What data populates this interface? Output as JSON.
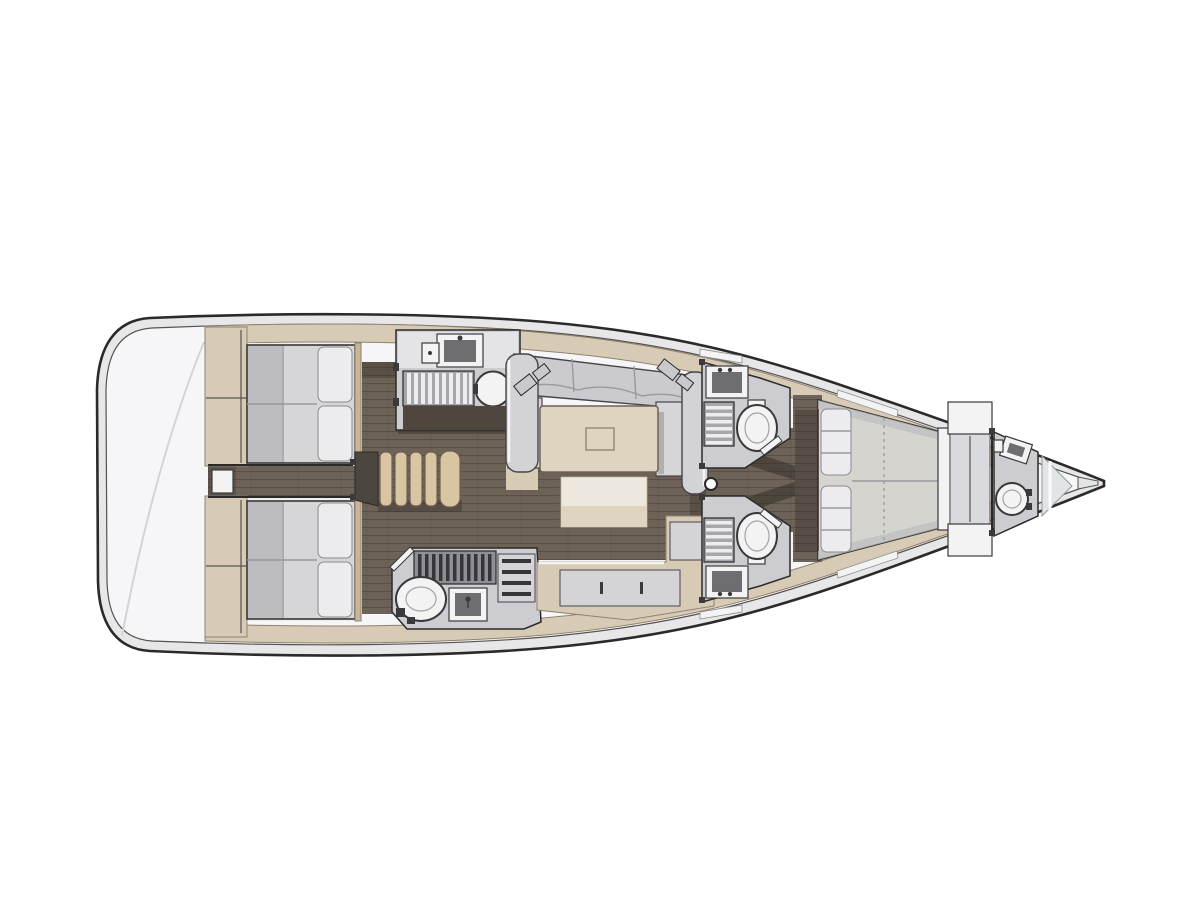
{
  "meta": {
    "title": "Sailing yacht interior layout plan, bow pointing right",
    "type": "floorplan-diagram",
    "orientation": "bow-right",
    "canvas": {
      "width": 1200,
      "height": 900
    }
  },
  "colors": {
    "bg": "#ffffff",
    "line-dark": "#2b2a28",
    "line-mid": "#55534f",
    "faint": "#d4d4d7",
    "hull-band": "#e7e7ea",
    "deck": "#f6f6f8",
    "beige": "#d8cbb6",
    "beige-border": "#8f8270",
    "beige-dark": "#c7b593",
    "floor": "#6d6257",
    "floor-line": "#594f45",
    "shadow": "#2e2922",
    "mattress": "#d6d6d9",
    "mattress-shade": "#bdbdc1",
    "pillow": "#ececee",
    "pillow-line": "#8a8a8e",
    "seam": "#9a9a9e",
    "sofa": "#cbcbcf",
    "sofa-light": "#d6d6d9",
    "arm": "#d3d3d6",
    "sofa-stroke": "#45444a",
    "lamp": "#c9c9cc",
    "table-tan": "#ded4c0",
    "table-border": "#6d6154",
    "table-inner": "#9a8d7a",
    "ottoman-top": "#ece8de",
    "inset": "#d4d4d8",
    "steps-tan": "#d8c6a3",
    "steps-dark": "#4b463f",
    "compartment": "#cdcdd1",
    "counter": "#e4e4e6",
    "fixture-white": "#f3f3f4",
    "fixture-inner": "#6e6e72",
    "grate-bg": "#a6a6ab",
    "grate-bar-light": "#ededef",
    "grate-dark": "#36363a",
    "grate-mid": "#8f8f95",
    "toilet-stroke": "#38383a",
    "rim": "#a3a3a7",
    "hardware": "#3a3a3e",
    "fwd-bed": "#d5d4ce",
    "panel": "#dadade",
    "glass": "#e2e5e8",
    "glass-stroke": "#94989c",
    "front-face-dark": "#4f463e"
  },
  "regions": {
    "hull": {
      "name": "hull-outline",
      "style": "double-line"
    },
    "transom": {
      "name": "transom-deck",
      "fixtures": [
        "deck-curve"
      ]
    },
    "aft_cabin_port": {
      "name": "aft-cabin-port",
      "fixtures": [
        "double-berth",
        "pillows",
        "wardrobe",
        "headboard"
      ]
    },
    "aft_cabin_starboard": {
      "name": "aft-cabin-starboard",
      "fixtures": [
        "double-berth",
        "pillows",
        "wardrobe",
        "headboard"
      ]
    },
    "companionway": {
      "name": "companionway",
      "fixtures": [
        "steps"
      ]
    },
    "galley": {
      "name": "galley",
      "fixtures": [
        "sink",
        "small-basin",
        "burner-grate",
        "round-basin"
      ]
    },
    "aft_head": {
      "name": "aft-head-starboard",
      "fixtures": [
        "toilet",
        "washbasin",
        "shower-grate",
        "shelf-rack",
        "door"
      ]
    },
    "salon": {
      "name": "salon",
      "fixtures": [
        "c-shaped-sofa",
        "reading-lamps",
        "coffee-table",
        "ottoman",
        "sideboard"
      ]
    },
    "head_port_mid": {
      "name": "head-port-mid",
      "fixtures": [
        "toilet",
        "washbasin",
        "shower-grate",
        "door"
      ]
    },
    "head_starboard_mid": {
      "name": "head-starboard-mid",
      "fixtures": [
        "toilet",
        "washbasin",
        "shower-grate",
        "door"
      ]
    },
    "owner_cabin": {
      "name": "owner-cabin-forward",
      "fixtures": [
        "island-berth",
        "pillows",
        "footboard",
        "wardrobe-panel",
        "lockers"
      ]
    },
    "bow_head": {
      "name": "bow-head",
      "fixtures": [
        "toilet",
        "washbasin"
      ]
    },
    "bow": {
      "name": "bow-area",
      "fixtures": [
        "anchor-locker-glass",
        "bow-fitting"
      ]
    },
    "mast": {
      "name": "mast-post"
    }
  }
}
